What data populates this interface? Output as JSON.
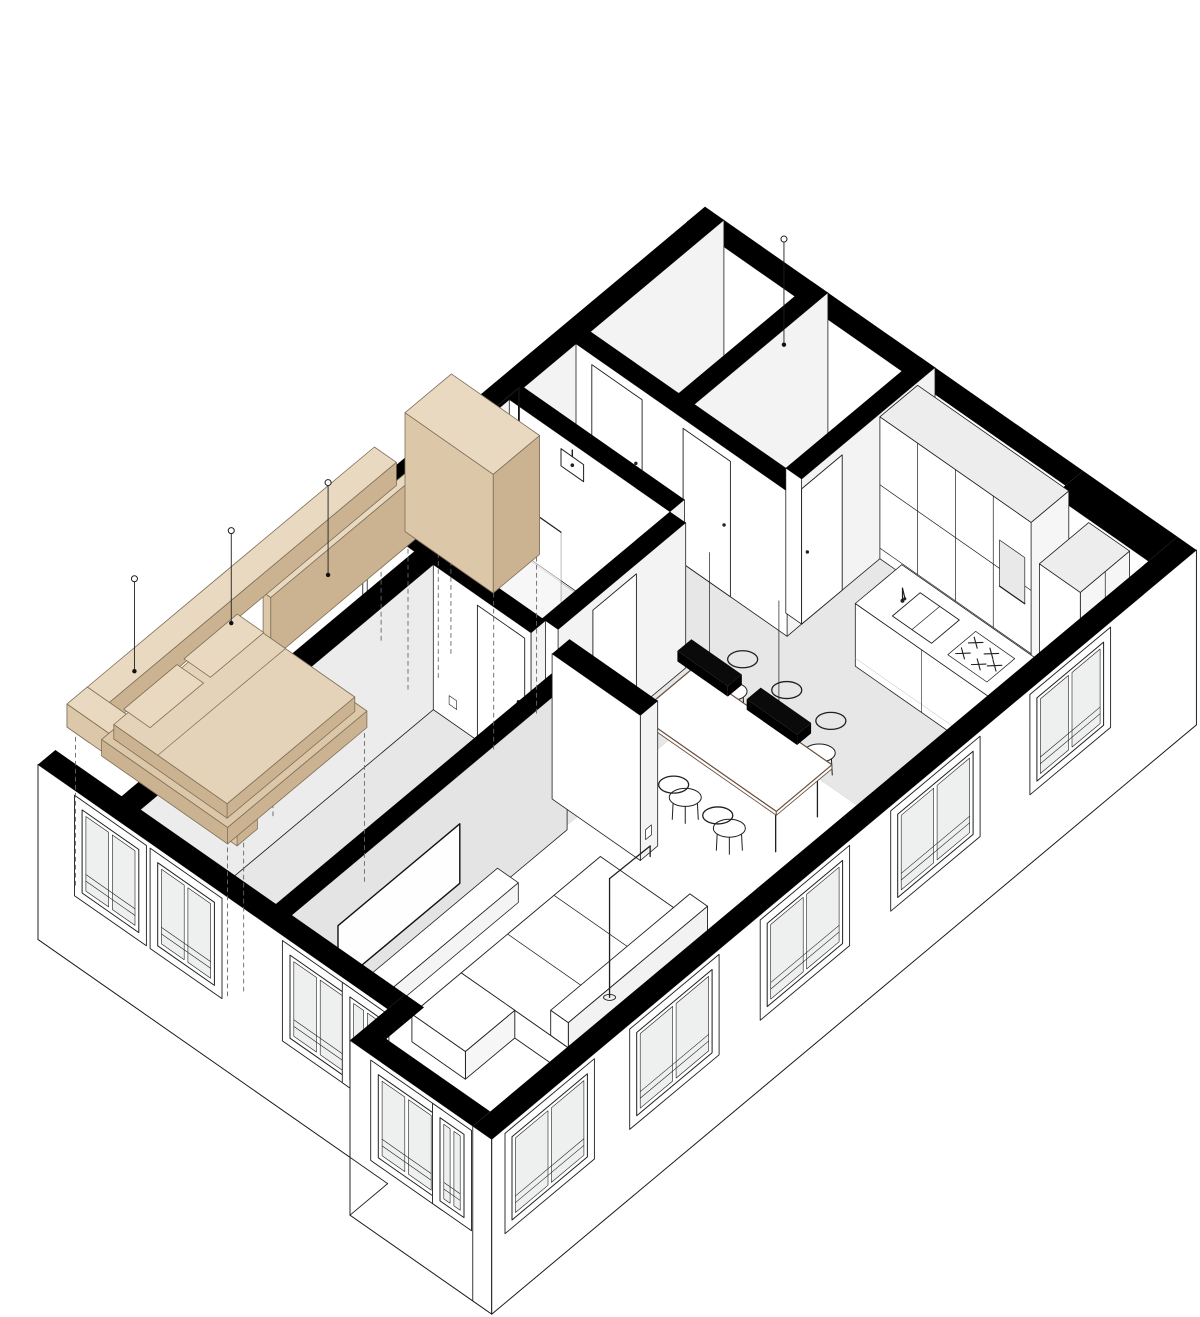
{
  "meta": {
    "drawing_type": "cutaway axonometric floor plan",
    "subject": "one-bedroom apartment interior"
  },
  "palette": {
    "background": "#ffffff",
    "cut": "#000000",
    "line": "#1f1f1f",
    "floor": "#e7e7e7",
    "face": "#f3f3f3",
    "face_dark": "#e4e4e4",
    "glass": "#eef0ef",
    "tray": "#efefef",
    "wood": "#dcc7a9",
    "wood_light": "#e8d9c0",
    "wood_dark": "#cbb391",
    "wood_edge": "#7d6e58",
    "table_edge": "#6b4f3f",
    "dash": "#666666",
    "white": "#ffffff"
  },
  "rooms": [
    {
      "name": "storage-room-a"
    },
    {
      "name": "storage-room-b"
    },
    {
      "name": "hallway"
    },
    {
      "name": "bathroom"
    },
    {
      "name": "bedroom"
    },
    {
      "name": "kitchen"
    },
    {
      "name": "dining-area"
    },
    {
      "name": "living-room"
    },
    {
      "name": "window-bay"
    }
  ],
  "inventory": {
    "dining_chairs": 6,
    "dining_pendant_bars": 2,
    "bedroom_pendant_cords": 3,
    "projection_lines": 12,
    "windows_left_facade": 4,
    "windows_bay": 2,
    "windows_right_facade": 5,
    "exploded_elements": [
      "bed",
      "mattress",
      "pillows",
      "headboard-panel",
      "canopy-beam-long",
      "canopy-beam-short",
      "wardrobe",
      "clothes-rail"
    ]
  },
  "layers": [
    {
      "name": "floors"
    },
    {
      "name": "far-facade-wall"
    },
    {
      "name": "top-left-wall"
    },
    {
      "name": "inner-room-walls"
    },
    {
      "name": "hall-doors"
    },
    {
      "name": "kitchen-cabinets"
    },
    {
      "name": "kitchen-tall-unit"
    },
    {
      "name": "bathroom-north-wall"
    },
    {
      "name": "shower"
    },
    {
      "name": "toilet"
    },
    {
      "name": "bathroom-east-wall"
    },
    {
      "name": "bathroom-door"
    },
    {
      "name": "kitchen-island"
    },
    {
      "name": "bedroom-north-wall"
    },
    {
      "name": "bedroom-door"
    },
    {
      "name": "bedroom-west-wall"
    },
    {
      "name": "tv-wall"
    },
    {
      "name": "media-unit"
    },
    {
      "name": "dining-set"
    },
    {
      "name": "dining-pendants"
    },
    {
      "name": "partition-wall"
    },
    {
      "name": "sofa"
    },
    {
      "name": "floor-lamp"
    },
    {
      "name": "facades"
    },
    {
      "name": "projection-lines"
    },
    {
      "name": "exploded-bedroom-furniture"
    },
    {
      "name": "ceiling-pendants"
    }
  ]
}
